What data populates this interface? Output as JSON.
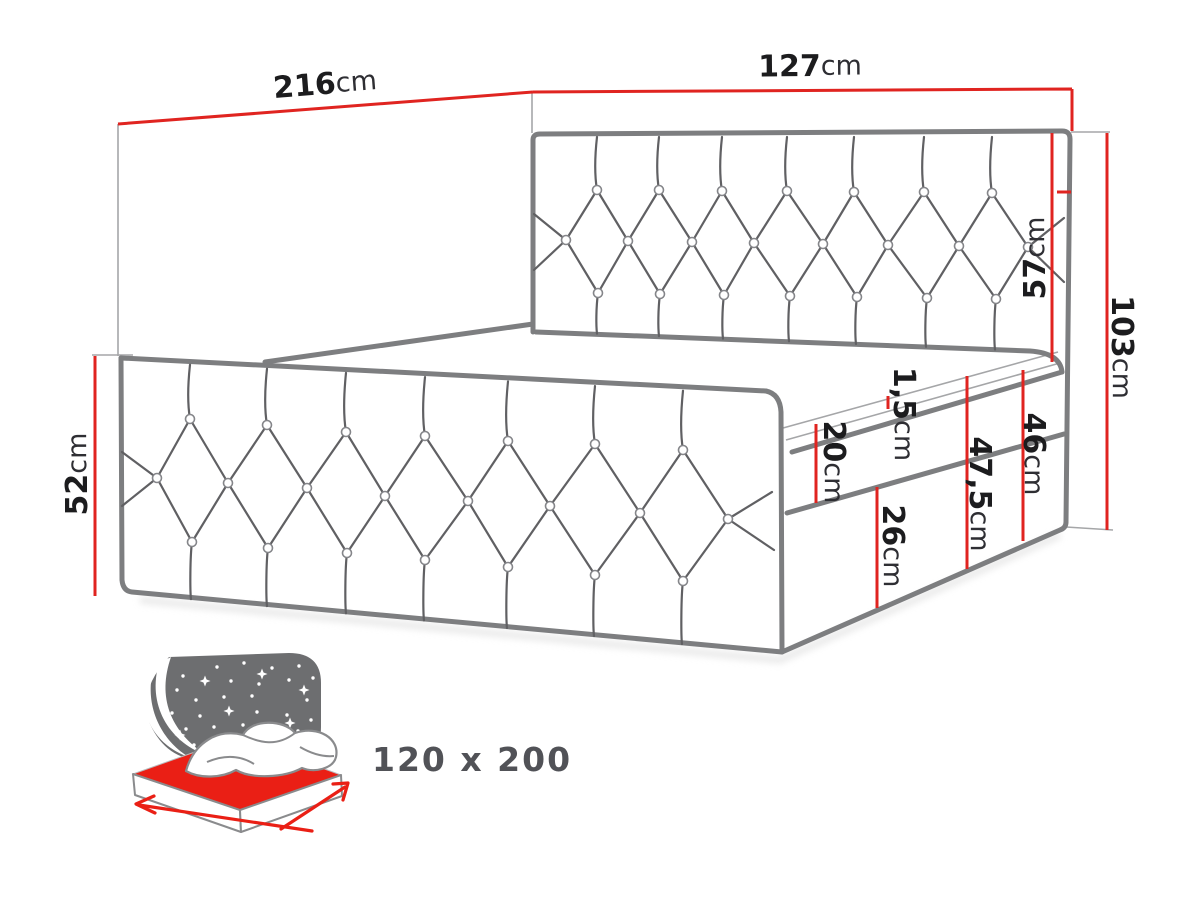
{
  "drawing": {
    "dimensions": [
      {
        "id": "total-length",
        "number": "216",
        "unit": "cm"
      },
      {
        "id": "headboard-width",
        "number": "127",
        "unit": "cm"
      },
      {
        "id": "headboard-above-mattress",
        "number": "57",
        "unit": "cm"
      },
      {
        "id": "total-height",
        "number": "103",
        "unit": "cm"
      },
      {
        "id": "side-height",
        "number": "52",
        "unit": "cm"
      },
      {
        "id": "topper-thickness",
        "number": "1,5",
        "unit": "cm"
      },
      {
        "id": "mattress-thickness",
        "number": "20",
        "unit": "cm"
      },
      {
        "id": "mattress-with-base",
        "number": "47,5",
        "unit": "cm"
      },
      {
        "id": "base-with-mattress",
        "number": "46",
        "unit": "cm"
      },
      {
        "id": "base-height",
        "number": "26",
        "unit": "cm"
      }
    ]
  },
  "badge": {
    "size_label": "120 x 200"
  },
  "colors": {
    "dimension_red": "#e02420",
    "icon_red": "#ea1f15",
    "outline_gray": "#7d7e80",
    "thin_gray": "#a5a6a8",
    "seam_gray": "#606063",
    "icon_gray": "#6d6e70",
    "text_dark": "#1c1c1e",
    "badge_text": "#515257"
  }
}
